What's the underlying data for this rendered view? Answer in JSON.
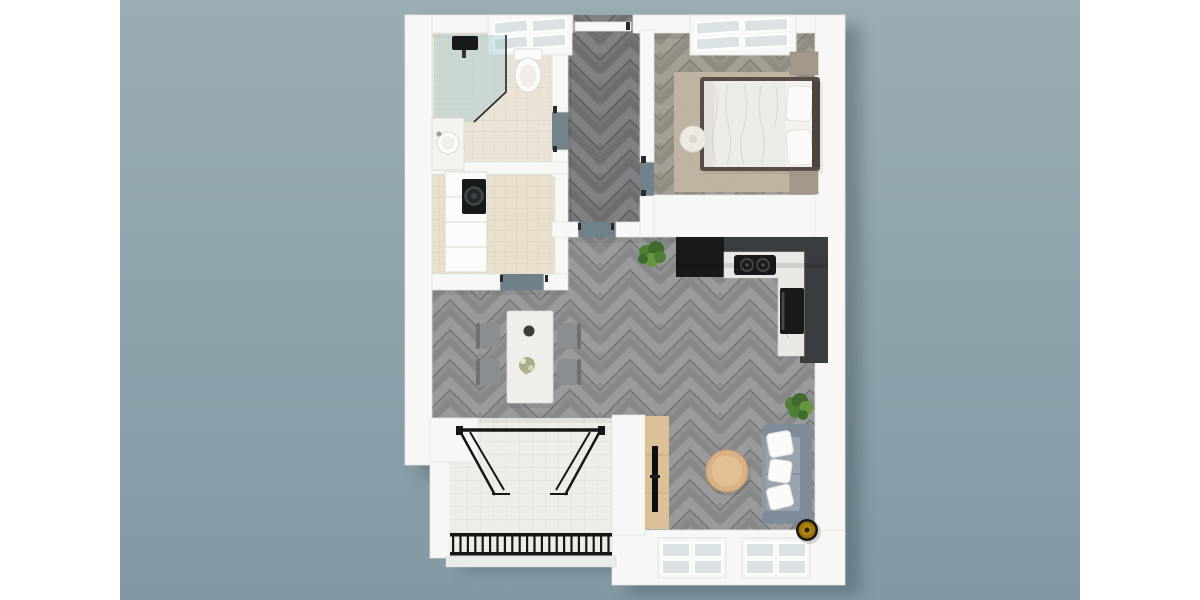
{
  "scene": {
    "type": "3d floor plan render, top-down view",
    "apartment": "one-bedroom apartment with balcony",
    "rooms": [
      "bathroom",
      "laundry-room",
      "hallway",
      "bedroom",
      "kitchen",
      "living-room",
      "dining-area",
      "balcony"
    ],
    "furnishings": [
      "walk-in shower",
      "toilet",
      "washbasin",
      "washing machine",
      "built-in cabinets",
      "double bed",
      "nightstands",
      "bedside pouf",
      "area rug",
      "l-shaped kitchen counter",
      "cooktop",
      "oven",
      "tall black cabinet",
      "marble dining table",
      "four chairs",
      "potted plants",
      "tv sideboard",
      "television",
      "round coffee table",
      "grey sofa with white pillows",
      "gold floor lamp",
      "black balcony railing",
      "folding glass doors",
      "windows",
      "entry door"
    ]
  },
  "colors": {
    "page_margin": "#ffffff",
    "backdrop_top": "#9badb4",
    "backdrop_bottom": "#8299a4",
    "shadow": "#3d4d57",
    "wall": "#f7f7f5",
    "wall_edge": "#e3e3e0",
    "wood_living": "#8e9091",
    "wood_living_seam": "#6c6e70",
    "wood_hall": "#767678",
    "wood_hall_seam": "#57585a",
    "wood_bedroom": "#989389",
    "wood_bedroom_seam": "#7b766c",
    "tile_bath": "#eae3d6",
    "tile_bath_line": "#dbd3c3",
    "tile_utility": "#e8dfcd",
    "tile_utility_line": "#d9cfba",
    "tile_balcony": "#efede7",
    "tile_balcony_line": "#dfddd4",
    "glass_pane": "#dbe2e4",
    "shower_glass": "#9fc8ce",
    "fixture_white": "#fbfbf9",
    "fixture_edge": "#dcd9d1",
    "appliance_black": "#17191b",
    "appliance_detail": "#43484b",
    "kitchen_dark": "#3a3d3f",
    "marble": "#eae8e4",
    "marble_vein": "#b8b5ae",
    "bed_frame": "#564e44",
    "headboard": "#4c443c",
    "sheet": "#f3f2ee",
    "duvet": "#edebe6",
    "duvet_line": "#d9d6cf",
    "pillow": "#fafaf8",
    "rug": "#c2b4a2",
    "nightstand": "#a5988a",
    "pouf": "#edeae4",
    "table_top": "#f0eeea",
    "chair": "#8a8e91",
    "chair_back": "#6d7174",
    "sofa": "#8d99a5",
    "sofa_dark": "#7e8b98",
    "sofa_seat": "#97a3af",
    "coffee_table": "#d9b184",
    "coffee_table_inner": "#e3bf94",
    "console": "#dcc097",
    "console_edge": "#c9ab7e",
    "tv": "#0c0d0e",
    "plant_dark": "#3f6b2c",
    "plant_mid": "#4f7f36",
    "plant_light": "#67963f",
    "metal_black": "#161616",
    "lamp_gold": "#cf9a18",
    "lamp_gold_dark": "#8f6a0a",
    "curb": "#e9ebe9"
  }
}
